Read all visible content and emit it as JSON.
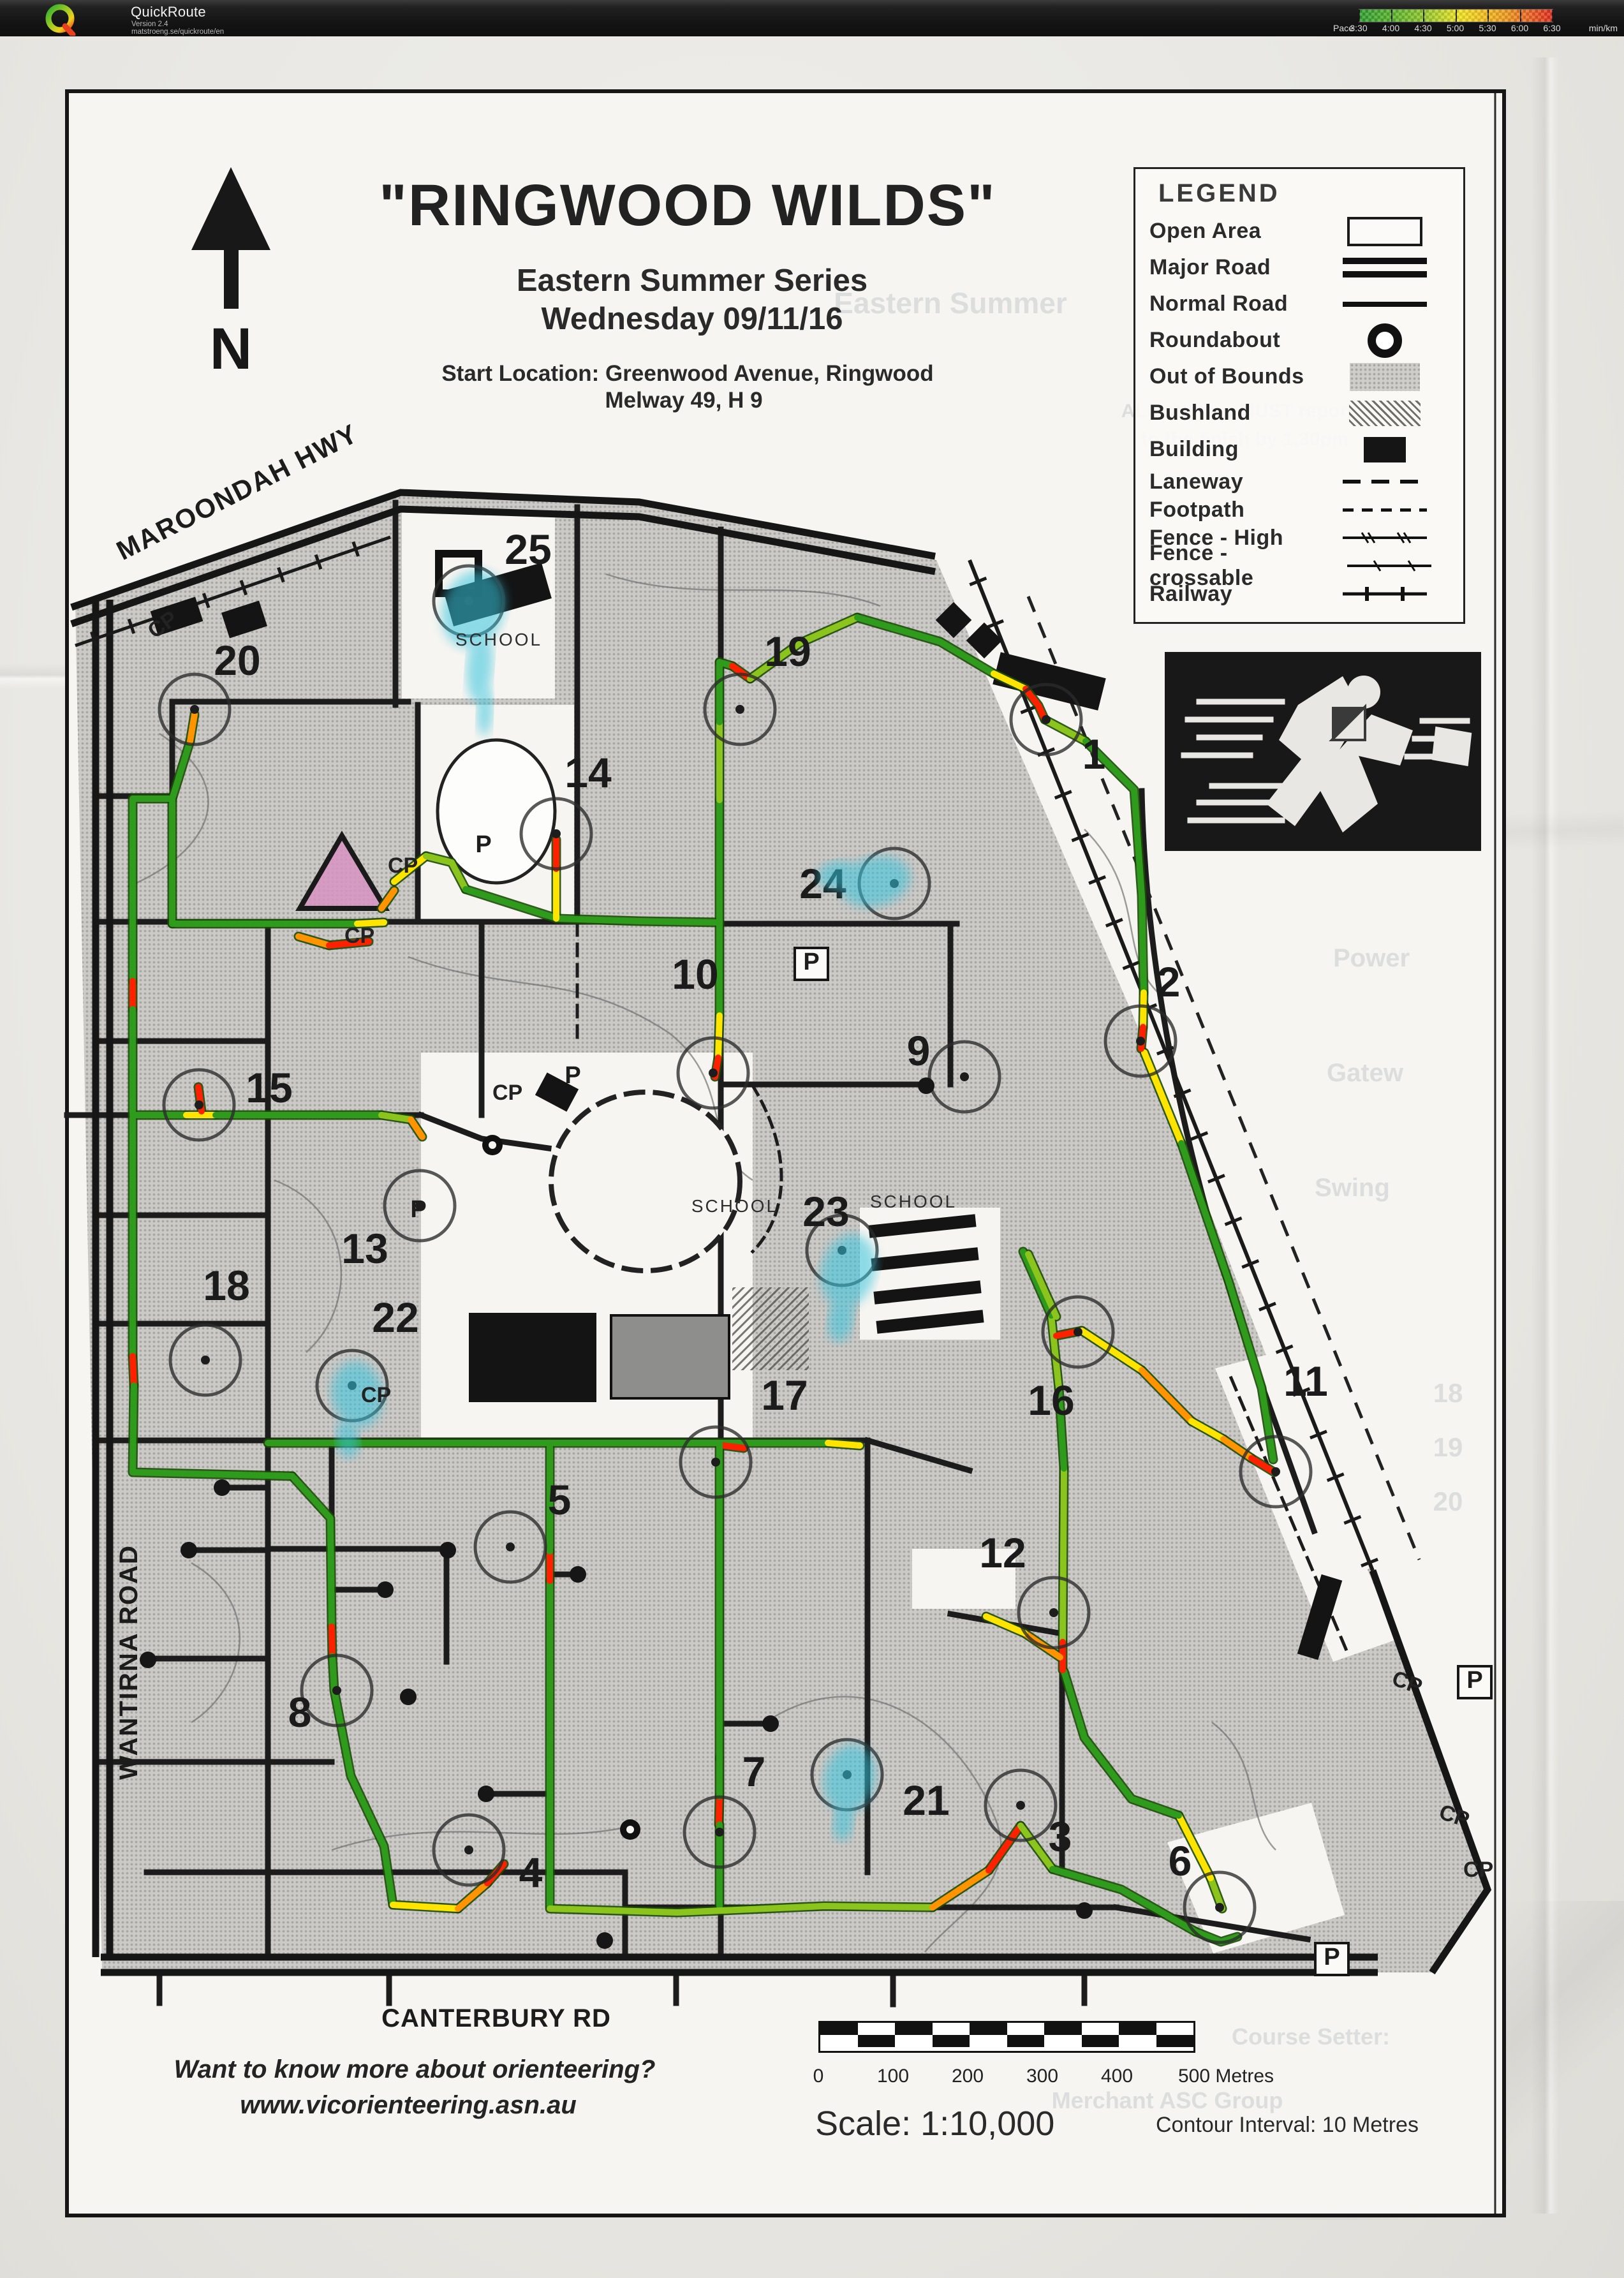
{
  "header": {
    "app_title": "QuickRoute",
    "version": "Version 2.4",
    "site": "matstroeng.se/quickroute/en",
    "pace": {
      "label": "Pace",
      "unit": "min/km",
      "ticks": [
        "3:30",
        "4:00",
        "4:30",
        "5:00",
        "5:30",
        "6:00",
        "6:30"
      ],
      "gradient": [
        "#2f9e2f",
        "#8fc72c",
        "#f2e321",
        "#ef9a1e",
        "#e02b1c"
      ]
    }
  },
  "map": {
    "title": "\"RINGWOOD WILDS\"",
    "series": "Eastern Summer Series",
    "date": "Wednesday 09/11/16",
    "start_location": "Start Location:  Greenwood Avenue, Ringwood",
    "melway": "Melway  49, H 9",
    "north": "N",
    "roads": {
      "maroondah": "MAROONDAH HWY",
      "wantirna": "WANTIRNA ROAD",
      "canterbury": "CANTERBURY RD"
    },
    "scale_text": "Scale:  1:10,000",
    "contour_text": "Contour Interval: 10 Metres",
    "scale_ticks": [
      "0",
      "100",
      "200",
      "300",
      "400",
      "500 Metres"
    ],
    "footer_line1": "Want to know more about orienteering?",
    "footer_line2": "www.vicorienteering.asn.au"
  },
  "legend": {
    "title": "LEGEND",
    "items": [
      {
        "label": "Open Area",
        "symbol": "open-area",
        "compact": false
      },
      {
        "label": "Major Road",
        "symbol": "major-road",
        "compact": false
      },
      {
        "label": "Normal Road",
        "symbol": "normal-road",
        "compact": false
      },
      {
        "label": "Roundabout",
        "symbol": "roundabout",
        "compact": false
      },
      {
        "label": "Out of Bounds",
        "symbol": "oob",
        "compact": false
      },
      {
        "label": "Bushland",
        "symbol": "bushland",
        "compact": false
      },
      {
        "label": "Building",
        "symbol": "building",
        "compact": false
      },
      {
        "label": "Laneway",
        "symbol": "laneway",
        "compact": true
      },
      {
        "label": "Footpath",
        "symbol": "footpath",
        "compact": true
      },
      {
        "label": "Fence - High",
        "symbol": "fence-high",
        "compact": true
      },
      {
        "label": "Fence - crossable",
        "symbol": "fence-crossable",
        "compact": true
      },
      {
        "label": "Railway",
        "symbol": "railway",
        "compact": true
      }
    ]
  },
  "map_render": {
    "cp_text": "CP",
    "p_text": "P",
    "school_text": "SCHOOL",
    "controls": [
      {
        "n": "1",
        "cx": 1640,
        "cy": 1128,
        "nx": 1715,
        "ny": 1205
      },
      {
        "n": "2",
        "cx": 1788,
        "cy": 1632,
        "nx": 1832,
        "ny": 1562
      },
      {
        "n": "3",
        "cx": 1600,
        "cy": 2830,
        "nx": 1662,
        "ny": 2902
      },
      {
        "n": "4",
        "cx": 735,
        "cy": 2900,
        "nx": 832,
        "ny": 2958
      },
      {
        "n": "5",
        "cx": 800,
        "cy": 2425,
        "nx": 877,
        "ny": 2374
      },
      {
        "n": "6",
        "cx": 1912,
        "cy": 2990,
        "nx": 1850,
        "ny": 2940
      },
      {
        "n": "7",
        "cx": 1128,
        "cy": 2872,
        "nx": 1182,
        "ny": 2800
      },
      {
        "n": "8",
        "cx": 528,
        "cy": 2650,
        "nx": 470,
        "ny": 2707
      },
      {
        "n": "9",
        "cx": 1512,
        "cy": 1688,
        "nx": 1440,
        "ny": 1670
      },
      {
        "n": "10",
        "cx": 1118,
        "cy": 1682,
        "nx": 1090,
        "ny": 1550
      },
      {
        "n": "11",
        "cx": 2000,
        "cy": 2307,
        "nx": 2047,
        "ny": 2188
      },
      {
        "n": "12",
        "cx": 1652,
        "cy": 2528,
        "nx": 1572,
        "ny": 2457
      },
      {
        "n": "13",
        "cx": 658,
        "cy": 1890,
        "nx": 572,
        "ny": 1980
      },
      {
        "n": "14",
        "cx": 872,
        "cy": 1307,
        "nx": 922,
        "ny": 1234
      },
      {
        "n": "15",
        "cx": 312,
        "cy": 1732,
        "nx": 422,
        "ny": 1728
      },
      {
        "n": "16",
        "cx": 1690,
        "cy": 2088,
        "nx": 1648,
        "ny": 2218
      },
      {
        "n": "17",
        "cx": 1122,
        "cy": 2292,
        "nx": 1230,
        "ny": 2210
      },
      {
        "n": "18",
        "cx": 322,
        "cy": 2132,
        "nx": 355,
        "ny": 2038
      },
      {
        "n": "19",
        "cx": 1160,
        "cy": 1112,
        "nx": 1235,
        "ny": 1044
      },
      {
        "n": "20",
        "cx": 305,
        "cy": 1112,
        "nx": 372,
        "ny": 1058
      },
      {
        "n": "21",
        "cx": 1328,
        "cy": 2782,
        "nx": 1452,
        "ny": 2845
      },
      {
        "n": "22",
        "cx": 552,
        "cy": 2172,
        "nx": 620,
        "ny": 2088
      },
      {
        "n": "23",
        "cx": 1320,
        "cy": 1960,
        "nx": 1295,
        "ny": 1922
      },
      {
        "n": "24",
        "cx": 1402,
        "cy": 1385,
        "nx": 1290,
        "ny": 1408
      },
      {
        "n": "25",
        "cx": 735,
        "cy": 942,
        "nx": 828,
        "ny": 884
      }
    ],
    "route_colors": {
      "G": "#2f9b1d",
      "LG": "#8cc41e",
      "Y": "#ffe400",
      "O": "#ff9400",
      "R": "#ff2000"
    },
    "route": [
      [
        "G",
        [
          270,
          1448,
          560,
          1448
        ]
      ],
      [
        "Y",
        [
          560,
          1448,
          602,
          1446
        ]
      ],
      [
        "O",
        [
          468,
          1468,
          516,
          1482
        ]
      ],
      [
        "R",
        [
          516,
          1482,
          578,
          1476
        ]
      ],
      [
        "O",
        [
          598,
          1424,
          618,
          1396
        ]
      ],
      [
        "Y",
        [
          618,
          1382,
          668,
          1342
        ]
      ],
      [
        "LG",
        [
          668,
          1342,
          708,
          1352,
          730,
          1394
        ]
      ],
      [
        "G",
        [
          730,
          1394,
          874,
          1440,
          1002,
          1444,
          1128,
          1446
        ]
      ],
      [
        "Y",
        [
          872,
          1440,
          872,
          1362
        ]
      ],
      [
        "R",
        [
          872,
          1362,
          872,
          1316
        ]
      ],
      [
        "G",
        [
          270,
          1448,
          270,
          1252,
          298,
          1162
        ]
      ],
      [
        "O",
        [
          298,
          1162,
          305,
          1120
        ]
      ],
      [
        "G",
        [
          270,
          1252,
          208,
          1252,
          208,
          1538
        ]
      ],
      [
        "R",
        [
          208,
          1538,
          208,
          1582
        ]
      ],
      [
        "G",
        [
          208,
          1582,
          208,
          1745
        ]
      ],
      [
        "G",
        [
          208,
          1748,
          292,
          1748
        ]
      ],
      [
        "Y",
        [
          292,
          1748,
          338,
          1748
        ]
      ],
      [
        "R",
        [
          316,
          1742,
          311,
          1704
        ]
      ],
      [
        "G",
        [
          338,
          1748,
          598,
          1748
        ]
      ],
      [
        "LG",
        [
          598,
          1748,
          644,
          1755
        ]
      ],
      [
        "O",
        [
          644,
          1755,
          662,
          1782
        ]
      ],
      [
        "G",
        [
          208,
          1752,
          208,
          2126
        ]
      ],
      [
        "R",
        [
          208,
          2126,
          210,
          2172
        ]
      ],
      [
        "G",
        [
          210,
          2172,
          208,
          2308,
          458,
          2314
        ]
      ],
      [
        "G",
        [
          458,
          2314,
          518,
          2380,
          520,
          2550
        ]
      ],
      [
        "R",
        [
          520,
          2550,
          521,
          2596
        ]
      ],
      [
        "G",
        [
          521,
          2596,
          524,
          2650,
          550,
          2784,
          602,
          2894,
          616,
          2986
        ]
      ],
      [
        "Y",
        [
          616,
          2986,
          718,
          2992
        ]
      ],
      [
        "O",
        [
          718,
          2992,
          764,
          2952
        ]
      ],
      [
        "R",
        [
          764,
          2952,
          790,
          2922
        ]
      ],
      [
        "G",
        [
          862,
          2988,
          862,
          2478
        ]
      ],
      [
        "R",
        [
          862,
          2478,
          862,
          2432
        ]
      ],
      [
        "G",
        [
          862,
          2432,
          862,
          2262
        ]
      ],
      [
        "G",
        [
          420,
          2262,
          1128,
          2262
        ]
      ],
      [
        "G",
        [
          1128,
          2262,
          1298,
          2262
        ]
      ],
      [
        "Y",
        [
          1298,
          2262,
          1348,
          2266
        ]
      ],
      [
        "R",
        [
          1134,
          2266,
          1166,
          2270
        ]
      ],
      [
        "G",
        [
          1128,
          2262,
          1128,
          2756
        ]
      ],
      [
        "R",
        [
          1128,
          2816,
          1127,
          2860
        ]
      ],
      [
        "G",
        [
          1128,
          2756,
          1128,
          2816
        ]
      ],
      [
        "G",
        [
          1128,
          2860,
          1128,
          2988
        ]
      ],
      [
        "LG",
        [
          862,
          2992,
          1062,
          2998,
          1292,
          2988,
          1462,
          2990
        ]
      ],
      [
        "O",
        [
          1462,
          2990,
          1550,
          2932
        ]
      ],
      [
        "R",
        [
          1550,
          2932,
          1600,
          2862
        ]
      ],
      [
        "LG",
        [
          1600,
          2862,
          1650,
          2930
        ]
      ],
      [
        "G",
        [
          1650,
          2930,
          1758,
          2962,
          1874,
          3028
        ]
      ],
      [
        "G",
        [
          1874,
          3028,
          1914,
          3044,
          1940,
          3036
        ]
      ],
      [
        "LG",
        [
          1898,
          2944,
          1916,
          2992
        ]
      ],
      [
        "Y",
        [
          1848,
          2846,
          1898,
          2944
        ]
      ],
      [
        "G",
        [
          1668,
          2620,
          1700,
          2724,
          1774,
          2820,
          1848,
          2846
        ]
      ],
      [
        "LG",
        [
          1668,
          2302,
          1666,
          2574
        ]
      ],
      [
        "R",
        [
          1666,
          2574,
          1666,
          2618
        ]
      ],
      [
        "O",
        [
          1662,
          2598,
          1606,
          2560
        ]
      ],
      [
        "Y",
        [
          1606,
          2560,
          1546,
          2534
        ]
      ],
      [
        "G",
        [
          1668,
          2302,
          1660,
          2176
        ]
      ],
      [
        "LG",
        [
          1660,
          2176,
          1648,
          2062
        ]
      ],
      [
        "G",
        [
          1648,
          2062,
          1604,
          1962
        ]
      ],
      [
        "LG",
        [
          1612,
          1966,
          1656,
          2064
        ]
      ],
      [
        "R",
        [
          1656,
          2094,
          1696,
          2086
        ]
      ],
      [
        "Y",
        [
          1696,
          2086,
          1790,
          2148
        ]
      ],
      [
        "O",
        [
          1790,
          2148,
          1868,
          2228
        ]
      ],
      [
        "Y",
        [
          1868,
          2228,
          1918,
          2256
        ]
      ],
      [
        "O",
        [
          1918,
          2256,
          1962,
          2286
        ]
      ],
      [
        "R",
        [
          1962,
          2286,
          1998,
          2308
        ]
      ],
      [
        "Y",
        [
          1794,
          1650,
          1852,
          1792
        ]
      ],
      [
        "G",
        [
          1852,
          1792,
          1926,
          2008,
          1978,
          2176,
          1996,
          2288
        ]
      ],
      [
        "G",
        [
          1128,
          1446,
          1128,
          1254
        ]
      ],
      [
        "LG",
        [
          1128,
          1254,
          1128,
          1132
        ]
      ],
      [
        "G",
        [
          1128,
          1132,
          1128,
          1038
        ]
      ],
      [
        "G",
        [
          1128,
          1446,
          1128,
          1592
        ]
      ],
      [
        "Y",
        [
          1128,
          1592,
          1126,
          1658
        ]
      ],
      [
        "R",
        [
          1126,
          1658,
          1121,
          1688
        ]
      ],
      [
        "G",
        [
          1128,
          1038,
          1148,
          1044
        ]
      ],
      [
        "R",
        [
          1148,
          1044,
          1176,
          1064
        ]
      ],
      [
        "LG",
        [
          1176,
          1064,
          1254,
          1008,
          1344,
          968
        ]
      ],
      [
        "G",
        [
          1344,
          968,
          1474,
          1006,
          1558,
          1056
        ]
      ],
      [
        "Y",
        [
          1558,
          1056,
          1608,
          1080
        ]
      ],
      [
        "R",
        [
          1608,
          1080,
          1628,
          1106,
          1638,
          1128
        ]
      ],
      [
        "LG",
        [
          1638,
          1128,
          1702,
          1162
        ]
      ],
      [
        "G",
        [
          1702,
          1162,
          1778,
          1238,
          1790,
          1404,
          1793,
          1556
        ]
      ],
      [
        "Y",
        [
          1793,
          1556,
          1792,
          1610
        ]
      ],
      [
        "R",
        [
          1792,
          1610,
          1789,
          1644
        ]
      ]
    ],
    "highlight_color": "#35c5de",
    "blobs": [
      {
        "x": 742,
        "y": 955,
        "rx": 48,
        "ry": 62,
        "rot": 18
      },
      {
        "x": 752,
        "y": 1045,
        "rx": 20,
        "ry": 56,
        "rot": 4
      },
      {
        "x": 760,
        "y": 1115,
        "rx": 12,
        "ry": 38,
        "rot": 2
      },
      {
        "x": 1372,
        "y": 1382,
        "rx": 56,
        "ry": 38,
        "rot": -14
      },
      {
        "x": 1312,
        "y": 1372,
        "rx": 30,
        "ry": 22,
        "rot": -10
      },
      {
        "x": 1330,
        "y": 1992,
        "rx": 42,
        "ry": 58,
        "rot": 14
      },
      {
        "x": 1318,
        "y": 2068,
        "rx": 20,
        "ry": 36,
        "rot": 8
      },
      {
        "x": 560,
        "y": 2186,
        "rx": 40,
        "ry": 52,
        "rot": -10
      },
      {
        "x": 545,
        "y": 2256,
        "rx": 18,
        "ry": 30,
        "rot": -6
      },
      {
        "x": 1332,
        "y": 2788,
        "rx": 40,
        "ry": 54,
        "rot": 12
      },
      {
        "x": 1322,
        "y": 2856,
        "rx": 16,
        "ry": 30,
        "rot": 6
      }
    ],
    "cp_labels": [
      {
        "x": 608,
        "y": 1368,
        "r": 0
      },
      {
        "x": 540,
        "y": 1478,
        "r": 0
      },
      {
        "x": 242,
        "y": 1002,
        "r": -35
      },
      {
        "x": 772,
        "y": 1724,
        "r": 0
      },
      {
        "x": 566,
        "y": 2198,
        "r": 0
      },
      {
        "x": 2180,
        "y": 2640,
        "r": 20
      },
      {
        "x": 2254,
        "y": 2850,
        "r": 18
      },
      {
        "x": 2294,
        "y": 2942,
        "r": 0
      }
    ],
    "p_labels": [
      {
        "x": 758,
        "y": 1336,
        "box": false
      },
      {
        "x": 898,
        "y": 1698,
        "box": false
      },
      {
        "x": 656,
        "y": 1908,
        "box": false
      },
      {
        "x": 1272,
        "y": 1520,
        "box": true
      },
      {
        "x": 2312,
        "y": 2646,
        "box": true
      },
      {
        "x": 2088,
        "y": 3080,
        "box": true
      }
    ],
    "school_labels": [
      {
        "x": 782,
        "y": 1012
      },
      {
        "x": 1152,
        "y": 1900
      },
      {
        "x": 1432,
        "y": 1893
      }
    ],
    "dots": [
      [
        348,
        2332
      ],
      [
        604,
        2492
      ],
      [
        232,
        2602
      ],
      [
        702,
        2430
      ],
      [
        906,
        2468
      ],
      [
        1208,
        2702
      ],
      [
        1452,
        1702
      ],
      [
        762,
        2812
      ],
      [
        296,
        2430
      ],
      [
        640,
        2660
      ],
      [
        1700,
        2995
      ],
      [
        948,
        3042
      ]
    ],
    "ghosts": [
      {
        "t": "Eastern Summer",
        "x": 1490,
        "y": 448,
        "s": 46
      },
      {
        "t": "ALL starters MUST report",
        "x": 1940,
        "y": 628,
        "s": 30
      },
      {
        "t": "to the finish by 1.30pm",
        "x": 1952,
        "y": 672,
        "s": 30
      },
      {
        "t": "18",
        "x": 2270,
        "y": 2160,
        "s": 42
      },
      {
        "t": "19",
        "x": 2270,
        "y": 2245,
        "s": 42
      },
      {
        "t": "20",
        "x": 2270,
        "y": 2330,
        "s": 42
      },
      {
        "t": "Power",
        "x": 2150,
        "y": 1480,
        "s": 40
      },
      {
        "t": "Gatew",
        "x": 2140,
        "y": 1660,
        "s": 40
      },
      {
        "t": "Swing",
        "x": 2120,
        "y": 1840,
        "s": 40
      },
      {
        "t": "Course Setter:",
        "x": 2055,
        "y": 3172,
        "s": 36
      },
      {
        "t": "Merchant ASC Group",
        "x": 1830,
        "y": 3272,
        "s": 36
      }
    ]
  }
}
